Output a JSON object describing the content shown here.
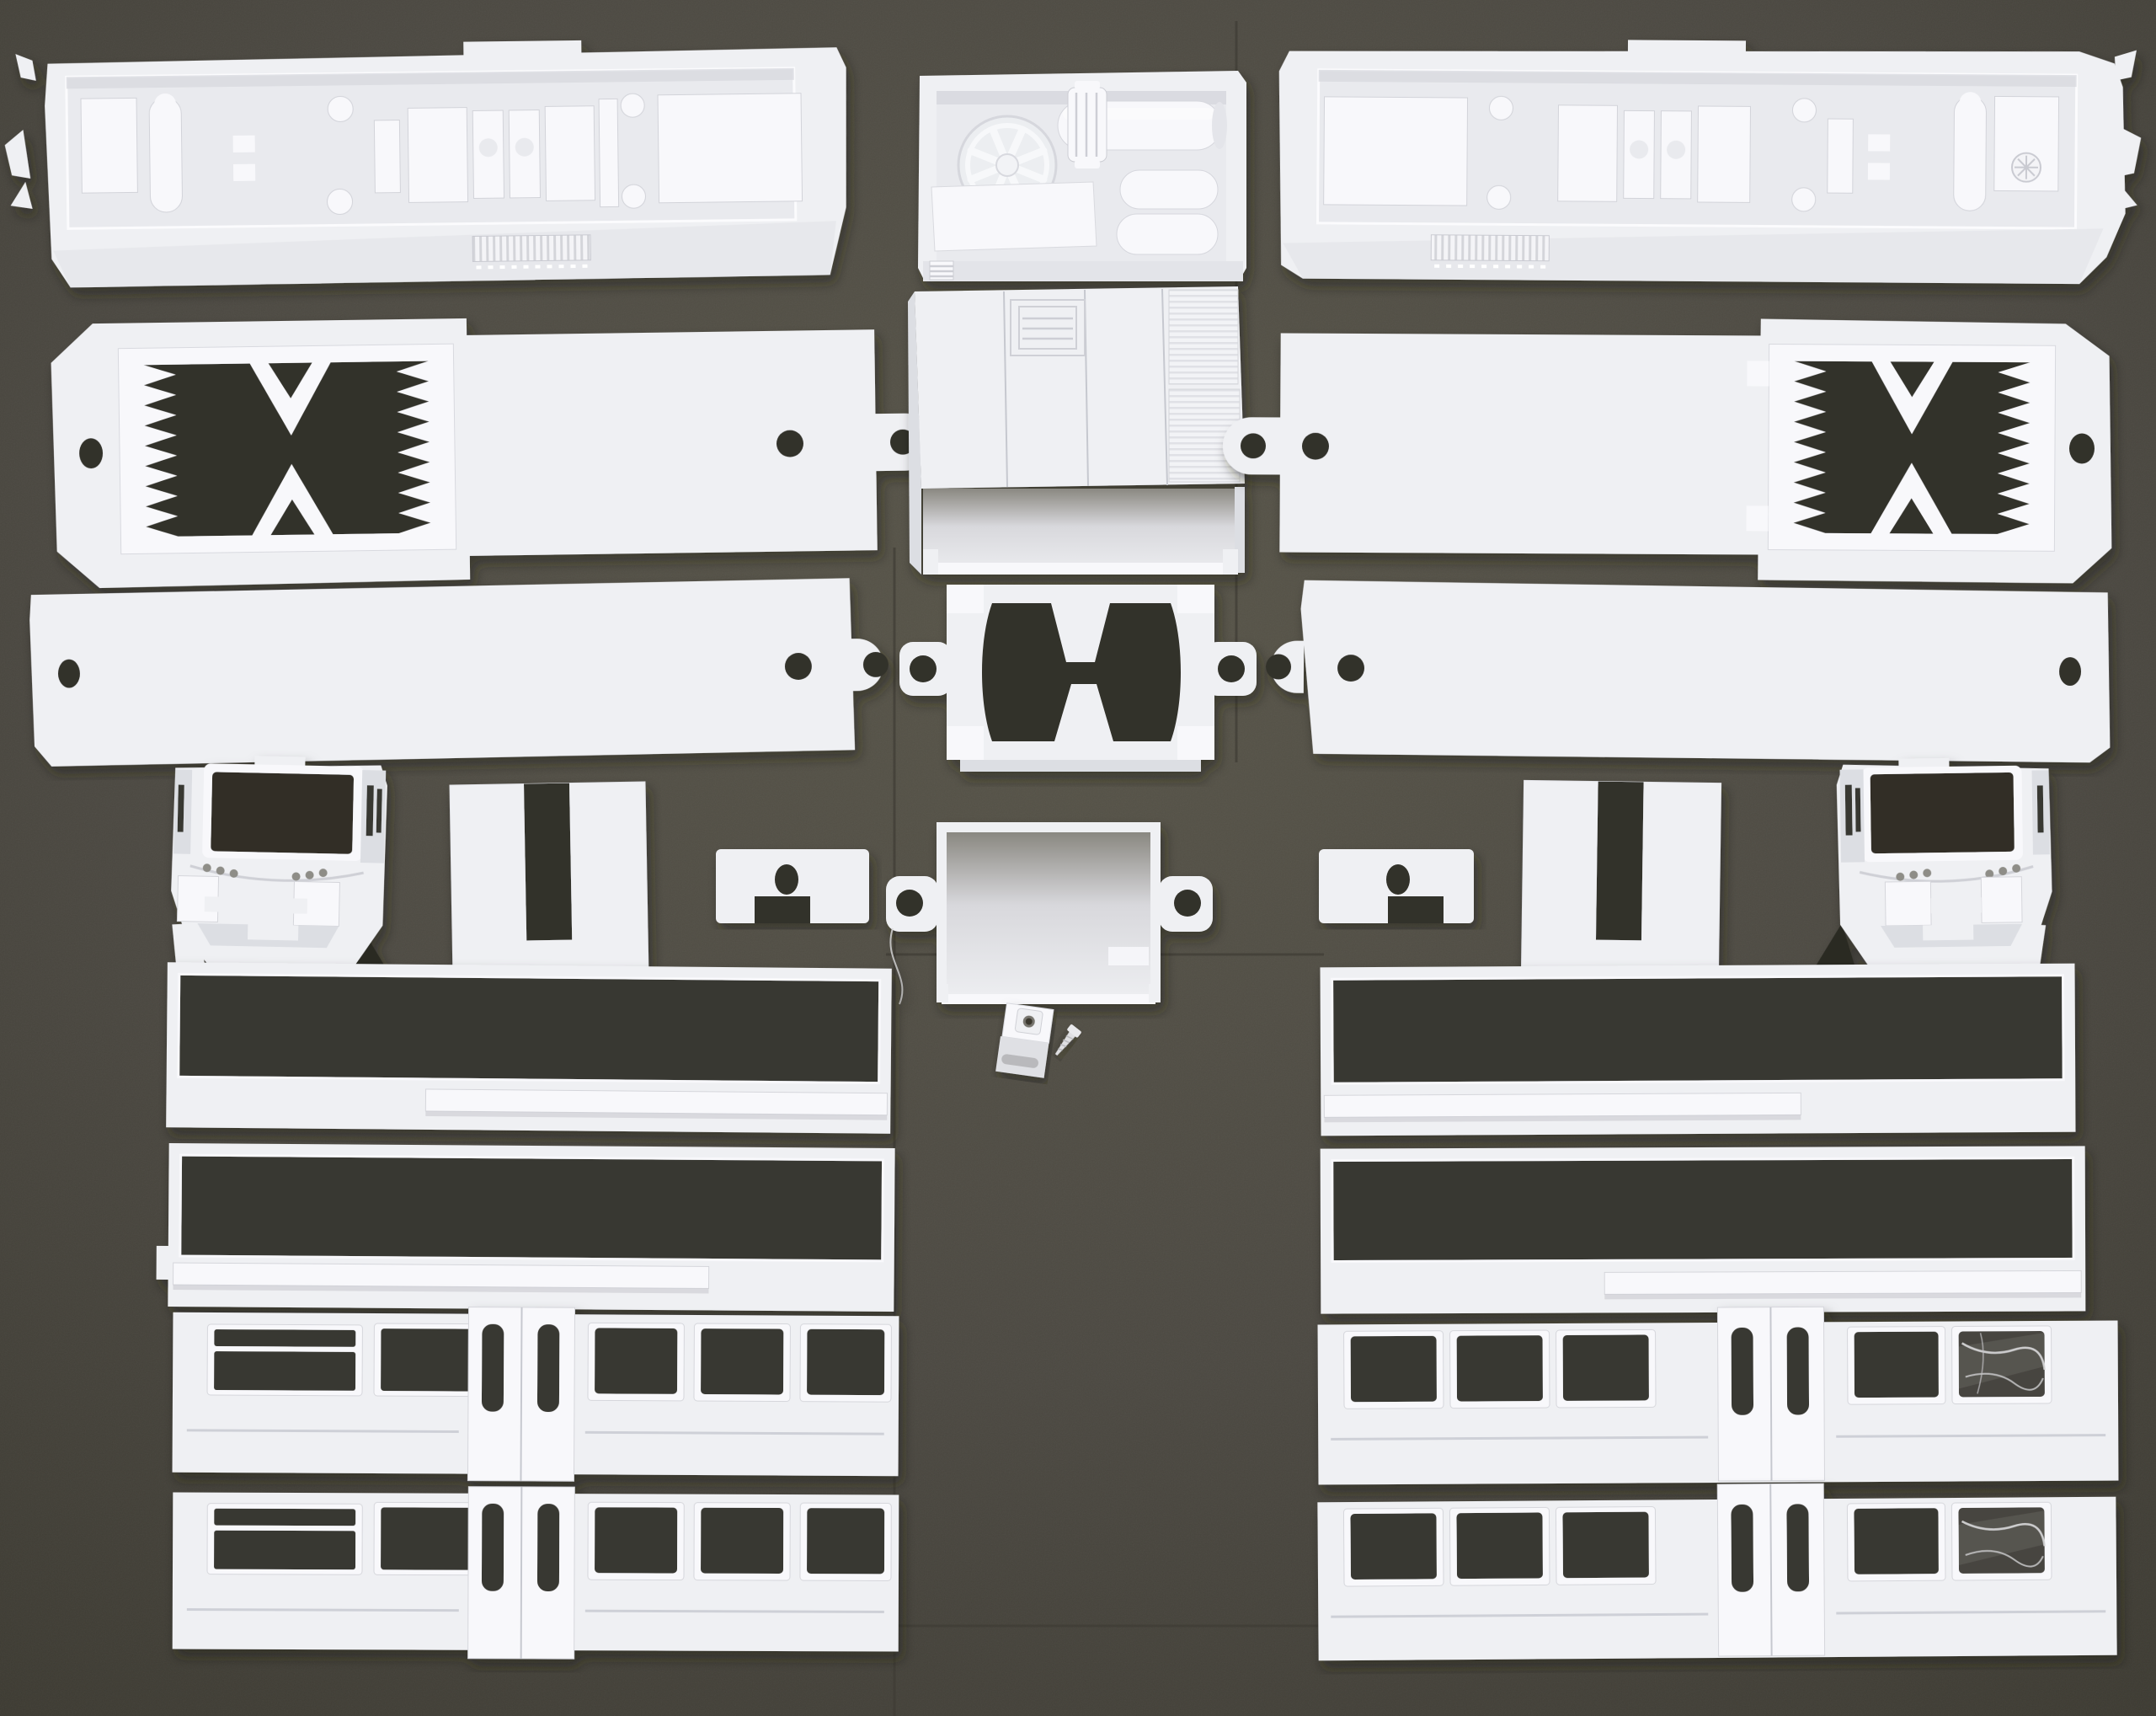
{
  "scene": {
    "description": "White 3D-printed model railway locomotive kit parts laid out in rows on a dark grey work mat",
    "colors": {
      "mat": "#4c4942",
      "mat_light": "#585549",
      "mat_dark": "#3a382f",
      "seam": "#3e3c35",
      "plastic": "#eff0f3",
      "plastic_bright": "#f8f8fb",
      "plastic_shade": "#dcdee3",
      "plastic_deep": "#c6c8cf",
      "recess": "#e9eaee",
      "opening": "#33312a",
      "window": "#393730",
      "shadow": "#1f1e19"
    }
  },
  "parts": [
    {
      "id": "roof-shell-left",
      "label": "Body roof shell, underside with detail blocks and vent grille (left)"
    },
    {
      "id": "engine-tray",
      "label": "Engine compartment tray with radiator fan, cylinder and air tanks"
    },
    {
      "id": "roof-shell-right",
      "label": "Body roof shell, underside with detail blocks and vent grille (right)"
    },
    {
      "id": "chassis-clamp-left",
      "label": "Chassis plate with serrated clamp opening and eyelet tab (left)"
    },
    {
      "id": "hood-unit",
      "label": "Hood unit with hatch and louvred radiator panels"
    },
    {
      "id": "chassis-clamp-right",
      "label": "Chassis plate with serrated clamp opening and eyelet tab (right)"
    },
    {
      "id": "floor-plate-left",
      "label": "Plain floor plate with mounting holes (left)"
    },
    {
      "id": "motor-mount-frame",
      "label": "Motor mount frame with bowed opening and eyelet ears"
    },
    {
      "id": "floor-plate-right",
      "label": "Plain floor plate with mounting holes (right)"
    },
    {
      "id": "cab-shell-left",
      "label": "Driver cab front shell with windscreen and bumper (left)"
    },
    {
      "id": "slotted-plate-left",
      "label": "Square plate with top slot (left)"
    },
    {
      "id": "clip-plate-left",
      "label": "Small clip plate with oval hole and notch (left)"
    },
    {
      "id": "cover-box",
      "label": "Open cover box with eyelet ears"
    },
    {
      "id": "clip-plate-right",
      "label": "Small clip plate with oval hole and notch (right)"
    },
    {
      "id": "slotted-plate-right",
      "label": "Square plate with top slot (right)"
    },
    {
      "id": "cab-shell-right",
      "label": "Driver cab front shell with windscreen and bumper (right)"
    },
    {
      "id": "mount-block",
      "label": "Small mounting block with screw boss"
    },
    {
      "id": "screw",
      "label": "Small self-tapping screw"
    },
    {
      "id": "window-frame-left-upper",
      "label": "Long glazing frame with sill strip (left, upper)"
    },
    {
      "id": "window-frame-left-lower",
      "label": "Long glazing frame with sill strip (left, lower)"
    },
    {
      "id": "side-wall-left-upper",
      "label": "Carriage side wall with door and window openings (left, upper)"
    },
    {
      "id": "side-wall-left-lower",
      "label": "Carriage side wall with door and window openings (left, lower)"
    },
    {
      "id": "window-frame-right-upper",
      "label": "Long glazing frame with sill strip (right, upper)"
    },
    {
      "id": "window-frame-right-lower",
      "label": "Long glazing frame with sill strip (right, lower)"
    },
    {
      "id": "side-wall-right-upper",
      "label": "Carriage side wall with door, windows and glazing film (right, upper)"
    },
    {
      "id": "side-wall-right-lower",
      "label": "Carriage side wall with door, windows and glazing film (right, lower)"
    }
  ]
}
